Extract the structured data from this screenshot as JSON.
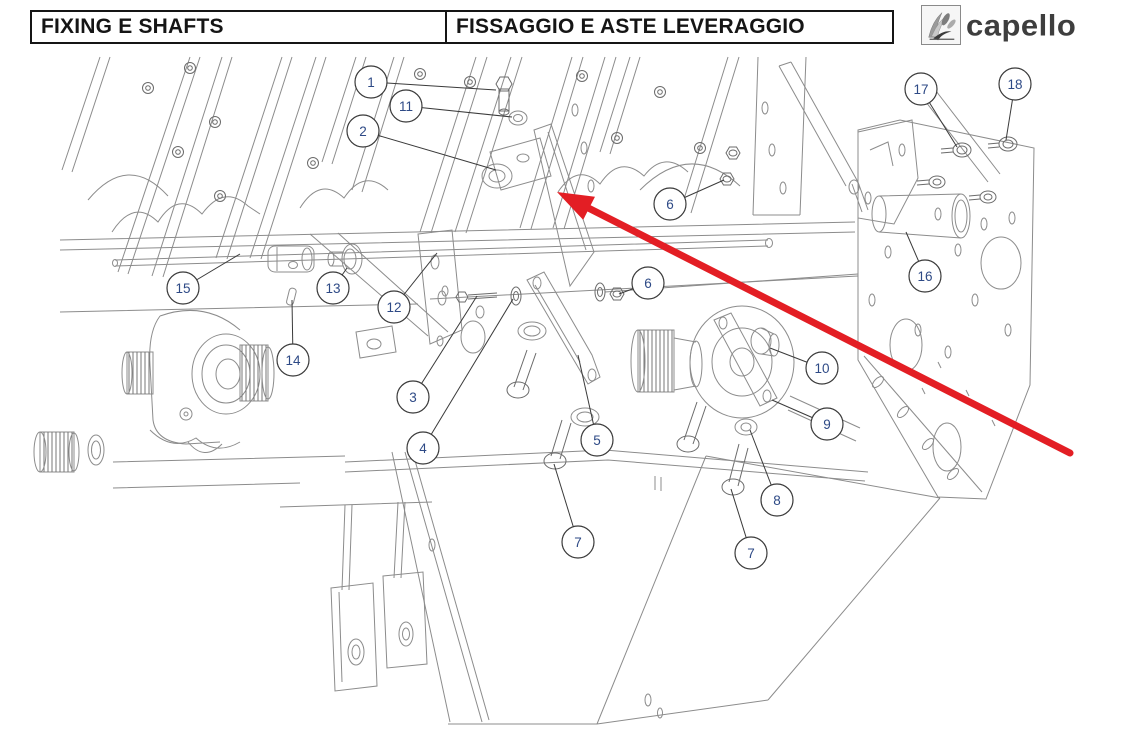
{
  "header": {
    "title_en": "FIXING E SHAFTS",
    "title_it": "FISSAGGIO E ASTE LEVERAGGIO",
    "brand": "capello"
  },
  "diagram": {
    "line_color": "#8c8c8c",
    "callout_stroke": "#3a3a3a",
    "callout_text_color": "#2e4a86",
    "arrow_color": "#e31e24",
    "callouts": [
      {
        "label": "1",
        "cx": 371,
        "cy": 82,
        "tx": 496,
        "ty": 90
      },
      {
        "label": "11",
        "cx": 406,
        "cy": 106,
        "tx": 512,
        "ty": 117
      },
      {
        "label": "2",
        "cx": 363,
        "cy": 131,
        "tx": 496,
        "ty": 170
      },
      {
        "label": "6",
        "cx": 670,
        "cy": 204,
        "tx": 724,
        "ty": 180
      },
      {
        "label": "6",
        "cx": 648,
        "cy": 283,
        "tx": 619,
        "ty": 294
      },
      {
        "label": "17",
        "cx": 921,
        "cy": 89,
        "tx": 957,
        "ty": 147
      },
      {
        "label": "18",
        "cx": 1015,
        "cy": 84,
        "tx": 1006,
        "ty": 140
      },
      {
        "label": "16",
        "cx": 925,
        "cy": 276,
        "tx": 906,
        "ty": 232
      },
      {
        "label": "15",
        "cx": 183,
        "cy": 288,
        "tx": 240,
        "ty": 254
      },
      {
        "label": "13",
        "cx": 333,
        "cy": 288,
        "tx": 347,
        "ty": 268
      },
      {
        "label": "12",
        "cx": 394,
        "cy": 307,
        "tx": 437,
        "ty": 253
      },
      {
        "label": "14",
        "cx": 293,
        "cy": 360,
        "tx": 292,
        "ty": 300
      },
      {
        "label": "3",
        "cx": 413,
        "cy": 397,
        "tx": 477,
        "ty": 296
      },
      {
        "label": "4",
        "cx": 423,
        "cy": 448,
        "tx": 513,
        "ty": 299
      },
      {
        "label": "5",
        "cx": 597,
        "cy": 440,
        "tx": 578,
        "ty": 355
      },
      {
        "label": "10",
        "cx": 822,
        "cy": 368,
        "tx": 770,
        "ty": 348
      },
      {
        "label": "9",
        "cx": 827,
        "cy": 424,
        "tx": 772,
        "ty": 400
      },
      {
        "label": "8",
        "cx": 777,
        "cy": 500,
        "tx": 750,
        "ty": 430
      },
      {
        "label": "7",
        "cx": 578,
        "cy": 542,
        "tx": 554,
        "ty": 464
      },
      {
        "label": "7",
        "cx": 751,
        "cy": 553,
        "tx": 731,
        "ty": 489
      }
    ],
    "red_arrow": {
      "tip_x": 557,
      "tip_y": 192,
      "tail_x": 1070,
      "tail_y": 453
    }
  }
}
